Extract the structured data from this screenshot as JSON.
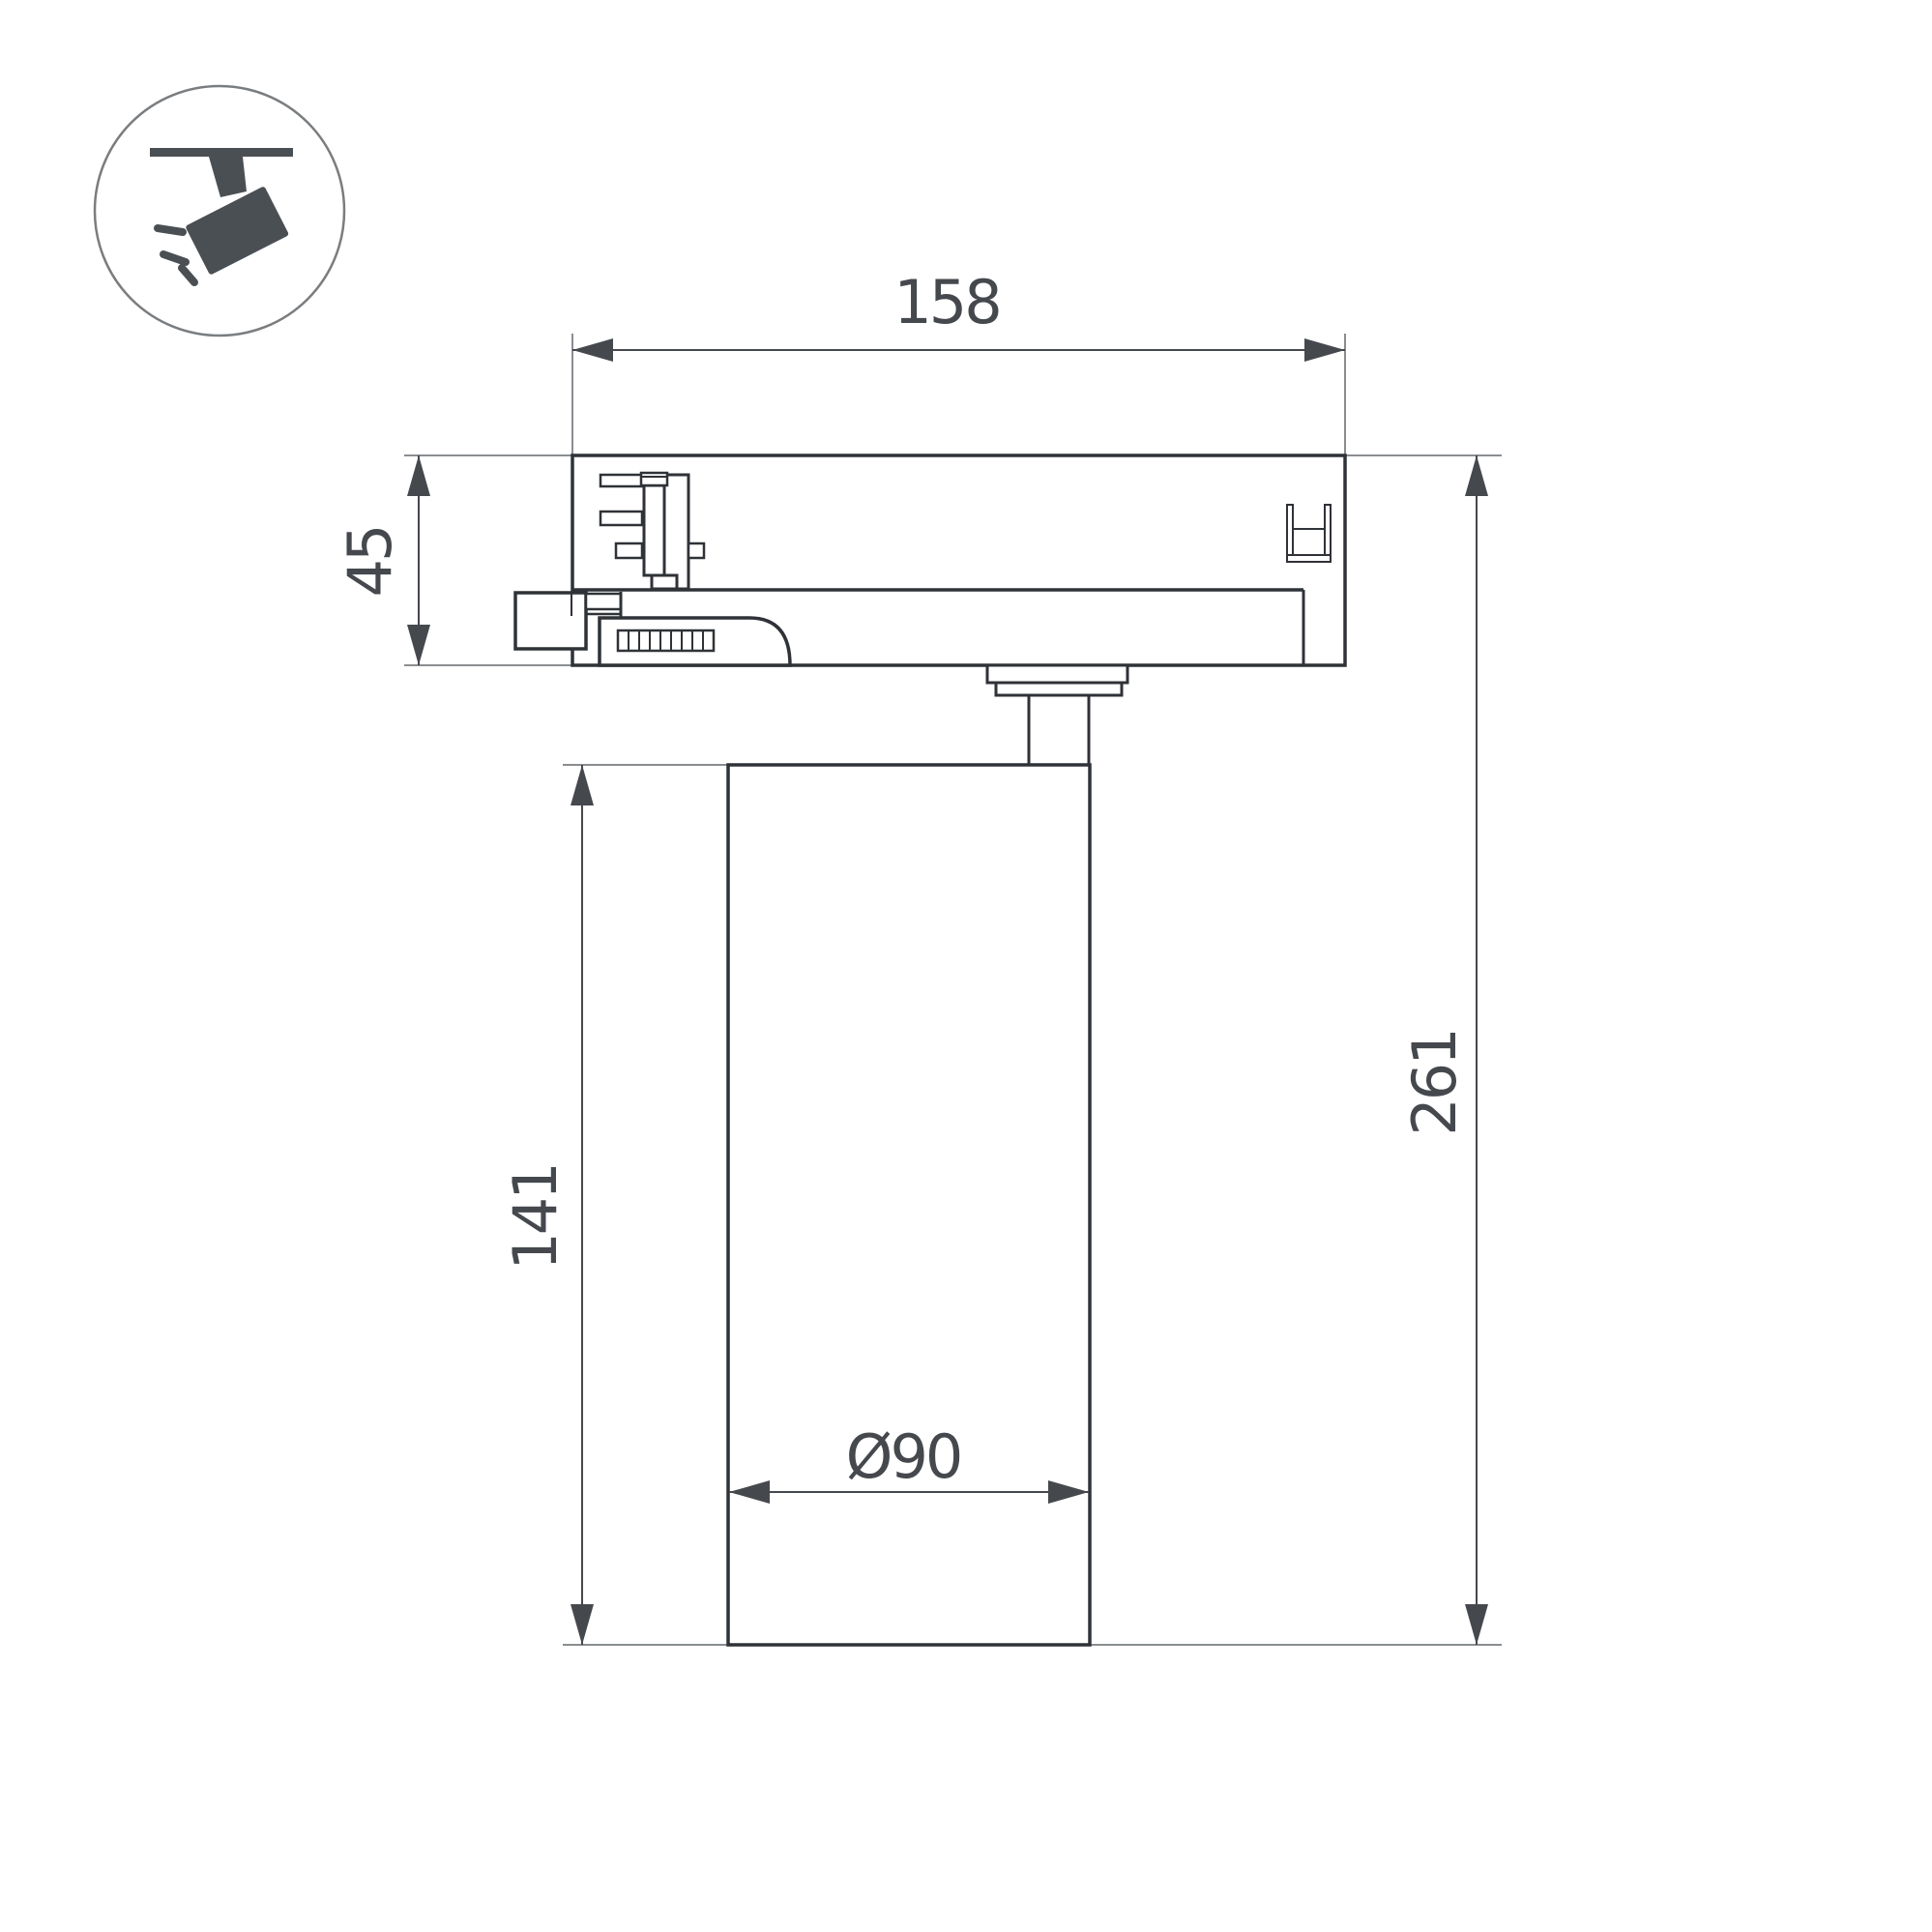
{
  "title": "Track spotlight dimensional drawing",
  "colors": {
    "bg": "#ffffff",
    "line": "#2f3237",
    "ext": "#8a8d90",
    "dim": "#45484d",
    "icon": "#4a4f54",
    "icon-ring": "#7a7d80"
  },
  "icon": {
    "name": "track-spotlight-icon"
  },
  "dimensions": {
    "width_top": {
      "value": "158"
    },
    "adapter_height": {
      "value": "45"
    },
    "body_height": {
      "value": "141"
    },
    "total_height": {
      "value": "261"
    },
    "body_diameter": {
      "value": "Ø90"
    }
  }
}
